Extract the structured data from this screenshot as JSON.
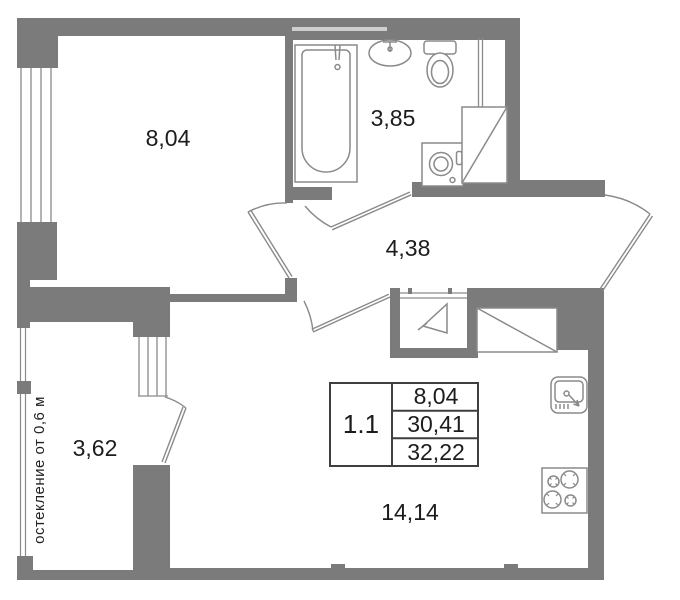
{
  "floorplan": {
    "unit": {
      "number": "1.1",
      "room_area": "8,04",
      "living_area": "30,41",
      "total_area": "32,22"
    },
    "rooms": [
      {
        "id": "bedroom",
        "area": "8,04"
      },
      {
        "id": "bathroom",
        "area": "3,85"
      },
      {
        "id": "hallway",
        "area": "4,38"
      },
      {
        "id": "balcony",
        "area": "3,62"
      },
      {
        "id": "kitchen-living",
        "area": "14,14"
      }
    ],
    "glazing_note": "остекление от 0,6 м",
    "colors": {
      "wall": "#7b7b7b",
      "fixture_line": "#8a8a8a",
      "text": "#1c1c1c",
      "table_border": "#3f3f3f",
      "background": "#ffffff"
    }
  }
}
